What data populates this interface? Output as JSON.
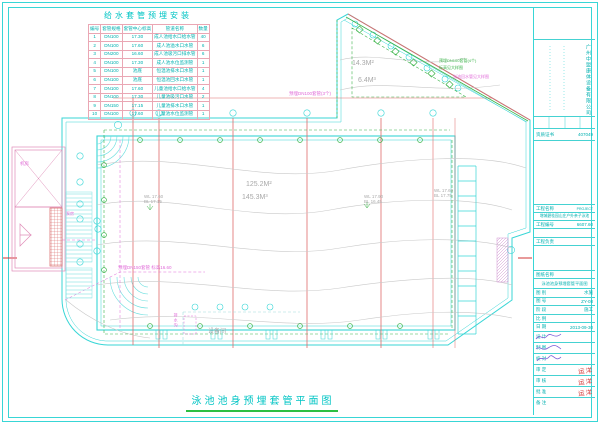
{
  "colors": {
    "cyan_line": "#38d6d6",
    "table_grid": "#eaa7b4",
    "grid_red": "#df6a6a",
    "pipe_green": "#3cb44a",
    "annotation_magenta": "#e06ad8",
    "contour_gray": "#c9c9c9",
    "stamp_red": "#d23434",
    "signature_purple": "#7b5bd6",
    "underline_green": "#2ebf43"
  },
  "sleeve_table": {
    "title": "给水套管预埋安装",
    "headers": [
      "编号",
      "套管规格",
      "套管中心标高",
      "管道名称",
      "数量"
    ],
    "rows": [
      {
        "no": "1",
        "spec": "DN100",
        "elev": "17.30",
        "name": "成人池给水口给水管",
        "qty": "40"
      },
      {
        "no": "2",
        "spec": "DN100",
        "elev": "17.60",
        "name": "成人池溢水口水管",
        "qty": "6"
      },
      {
        "no": "3",
        "spec": "DN200",
        "elev": "16.60",
        "name": "成人池吸污口排水管",
        "qty": "6"
      },
      {
        "no": "4",
        "spec": "DN100",
        "elev": "17.30",
        "name": "成人池水位监测管",
        "qty": "1"
      },
      {
        "no": "5",
        "spec": "DN100",
        "elev": "池底",
        "name": "恒温池排水口水管",
        "qty": "1"
      },
      {
        "no": "6",
        "spec": "DN100",
        "elev": "池底",
        "name": "恒温池回水口水管",
        "qty": "1"
      },
      {
        "no": "7",
        "spec": "DN100",
        "elev": "17.60",
        "name": "儿童池给水口给水管",
        "qty": "4"
      },
      {
        "no": "8",
        "spec": "DN100",
        "elev": "17.30",
        "name": "儿童池吸污口水管",
        "qty": "2"
      },
      {
        "no": "9",
        "spec": "DN150",
        "elev": "17.15",
        "name": "儿童池排水口水管",
        "qty": "1"
      },
      {
        "no": "10",
        "spec": "DN100",
        "elev": "17.60",
        "name": "儿童池水位监测管",
        "qty": "1"
      }
    ]
  },
  "plan": {
    "adult_pool": {
      "area": "125.2M²",
      "volume": "145.3M³"
    },
    "kids_pool": {
      "area": "14.3M²",
      "volume": "6.4M³"
    },
    "levels": [
      {
        "wl": "WL 17.60",
        "bl": "BL 17.15"
      },
      {
        "wl": "WL 17.90",
        "bl": "BL 16.45"
      },
      {
        "wl": "WL 17.60",
        "bl": "BL 17.75"
      }
    ],
    "rooms": {
      "plant_room": "机房",
      "pump_room": "泵房",
      "equipment_room": "设备间",
      "drain": "排水沟"
    },
    "annotations": [
      {
        "text": "预埋DN150套管 标高16.60"
      },
      {
        "text": "预埋DN100套管(3个)"
      },
      {
        "text": "预埋DN100套管(4个)"
      },
      {
        "text": "标高见大样图"
      },
      {
        "text": "溢流回水管见大样图"
      }
    ]
  },
  "titles": {
    "main": "泳池池身预埋套管平面图"
  },
  "title_block": {
    "company": "广州中盟康体设备有限公司",
    "cert": {
      "label": "资质证书",
      "value": "407049"
    },
    "project": {
      "label": "工程名称",
      "tag": "PROJECT",
      "name": "增城碧桂园山庄户外亲子泳池"
    },
    "job_no": {
      "label": "工程编号",
      "value": "6607.60"
    },
    "lead": {
      "label": "工程负责",
      "value": ""
    },
    "drawing": {
      "label": "图纸名称",
      "name": "泳池池身预埋套管平面图"
    },
    "fields": [
      {
        "label": "图 别",
        "value": "水施"
      },
      {
        "label": "图 号",
        "value": "ZY-08"
      },
      {
        "label": "阶 段",
        "value": "施工"
      },
      {
        "label": "比 例",
        "value": ""
      },
      {
        "label": "日 期",
        "value": "2013-09-30"
      }
    ],
    "sign_rows": [
      {
        "label": "设 计"
      },
      {
        "label": "制 图"
      },
      {
        "label": "校 对"
      }
    ],
    "stamp_rows": [
      {
        "label": "审 定",
        "stamp": "运洋"
      },
      {
        "label": "审 核",
        "stamp": "运洋"
      },
      {
        "label": "批 准",
        "stamp": "运洋"
      }
    ],
    "note_label": "备 注"
  }
}
